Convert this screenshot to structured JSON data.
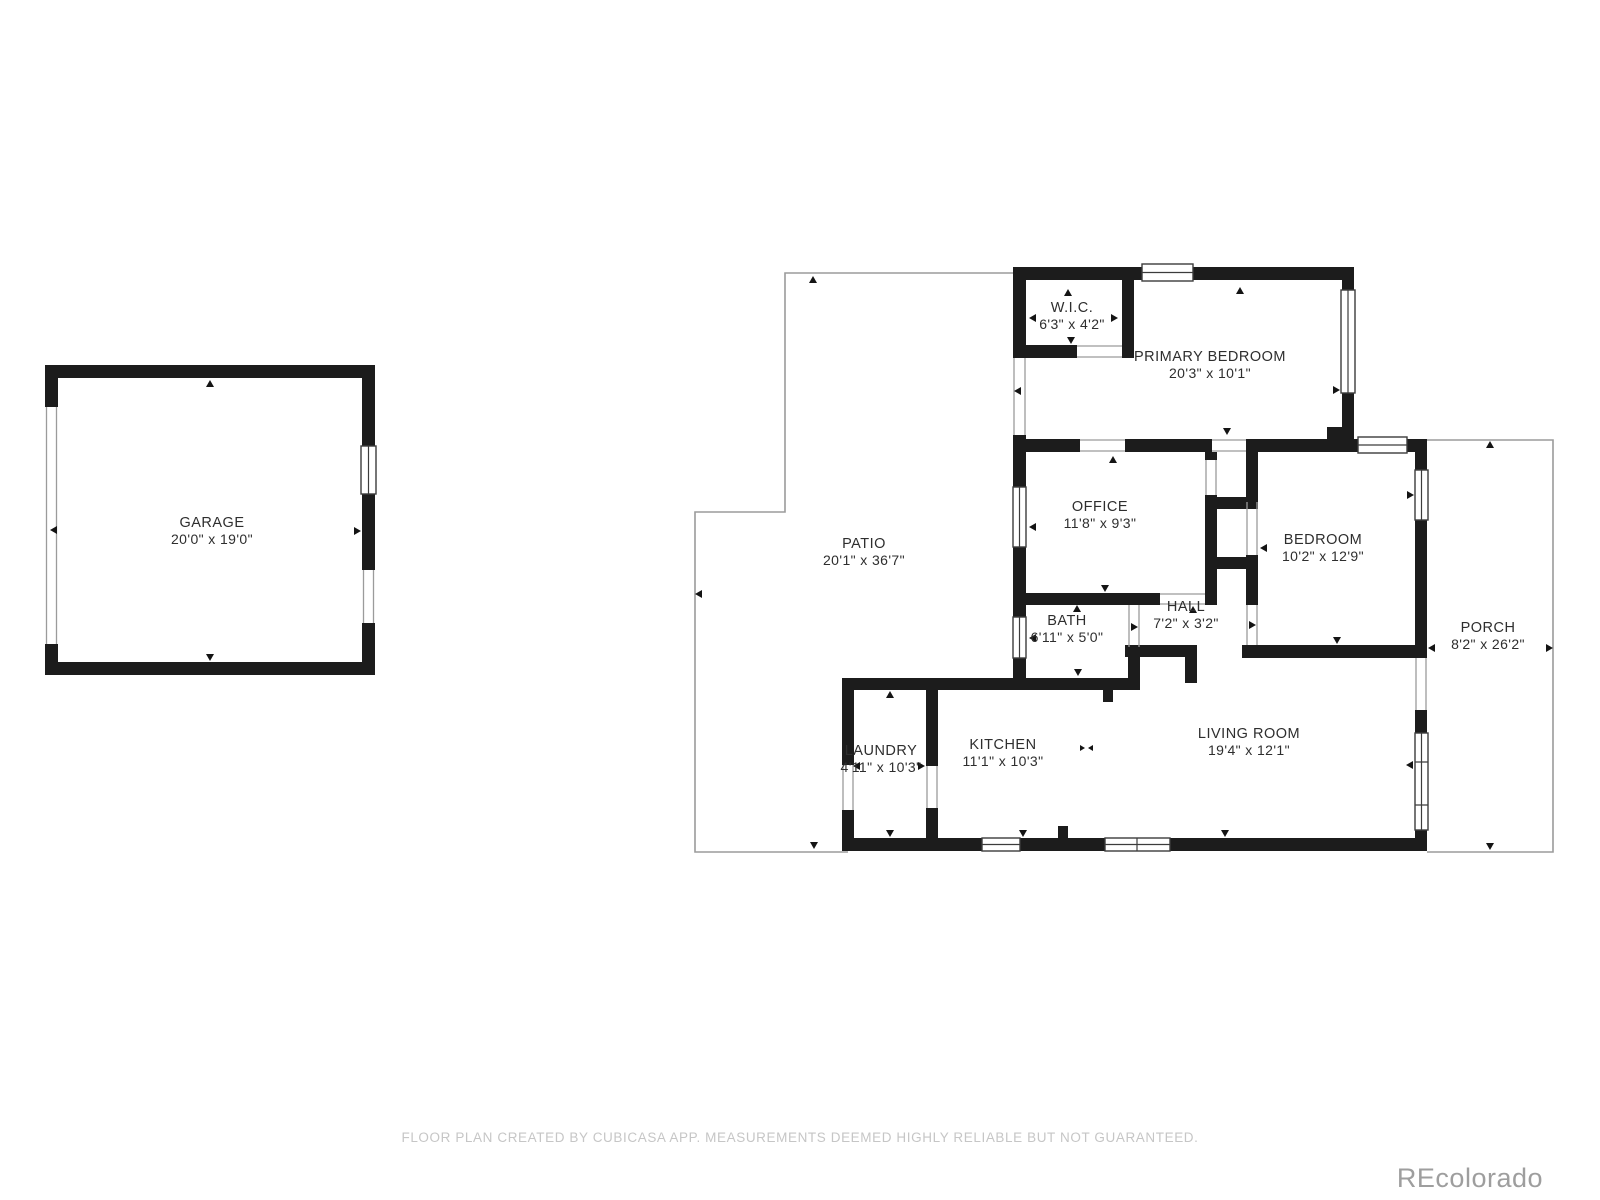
{
  "plan": {
    "footer": "FLOOR PLAN CREATED BY CUBICASA APP. MEASUREMENTS DEEMED HIGHLY RELIABLE BUT NOT GUARANTEED.",
    "watermark": "REcolorado"
  },
  "colors": {
    "wall": "#1c1c1c",
    "thin_outline": "#9b9b9b",
    "label": "#2e2e2e",
    "footer": "#c6c6c6",
    "watermark": "#9e9e9e"
  },
  "rooms": {
    "garage": {
      "name": "GARAGE",
      "dims": "20'0\" x 19'0\""
    },
    "wic": {
      "name": "W.I.C.",
      "dims": "6'3\" x 4'2\""
    },
    "primary_bedroom": {
      "name": "PRIMARY BEDROOM",
      "dims": "20'3\" x 10'1\""
    },
    "office": {
      "name": "OFFICE",
      "dims": "11'8\" x 9'3\""
    },
    "bedroom": {
      "name": "BEDROOM",
      "dims": "10'2\" x 12'9\""
    },
    "patio": {
      "name": "PATIO",
      "dims": "20'1\" x 36'7\""
    },
    "hall": {
      "name": "HALL",
      "dims": "7'2\" x 3'2\""
    },
    "bath": {
      "name": "BATH",
      "dims": "6'11\" x 5'0\""
    },
    "porch": {
      "name": "PORCH",
      "dims": "8'2\" x 26'2\""
    },
    "laundry": {
      "name": "LAUNDRY",
      "dims": "4'11\" x 10'3\""
    },
    "kitchen": {
      "name": "KITCHEN",
      "dims": "11'1\" x 10'3\""
    },
    "living_room": {
      "name": "LIVING ROOM",
      "dims": "19'4\" x 12'1\""
    }
  }
}
